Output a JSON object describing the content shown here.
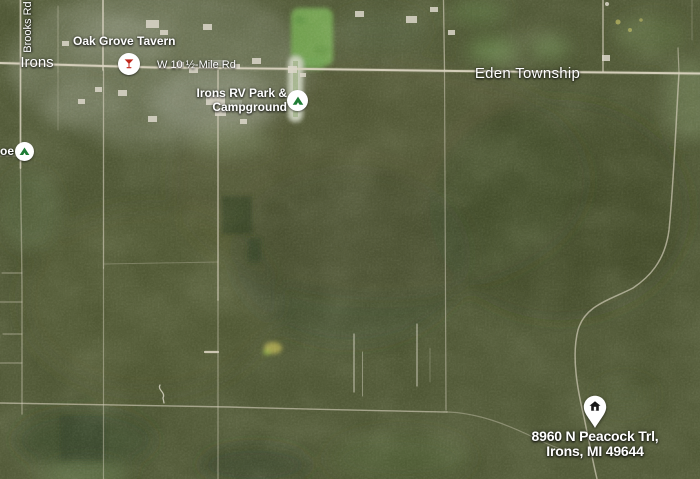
{
  "map": {
    "labels": {
      "brooks_rd": "Brooks Rd",
      "town": "Irons",
      "mile_road": "W 10 ½-Mile Rd",
      "township": "Eden Township"
    },
    "pois": {
      "tavern": {
        "name": "Oak Grove Tavern",
        "icon": "martini-glass-icon"
      },
      "rv_park": {
        "line1": "Irons RV Park &",
        "line2": "Campground",
        "icon": "campground-tent-icon"
      },
      "edge_poi": {
        "partial_name": "oe",
        "icon": "campground-tent-icon"
      }
    },
    "destination": {
      "line1": "8960 N Peacock Trl,",
      "line2": "Irons, MI 49644",
      "icon": "home-pin-icon"
    },
    "colors": {
      "forest": "#4a5230",
      "road": "#d8d2bf",
      "meadow": "#6ca14b",
      "label_text": "#ffffff",
      "bar_red": "#c0271c",
      "camp_green": "#1f7d36",
      "pin_fill": "#ffffff",
      "pin_glyph": "#1a1a1a"
    }
  }
}
